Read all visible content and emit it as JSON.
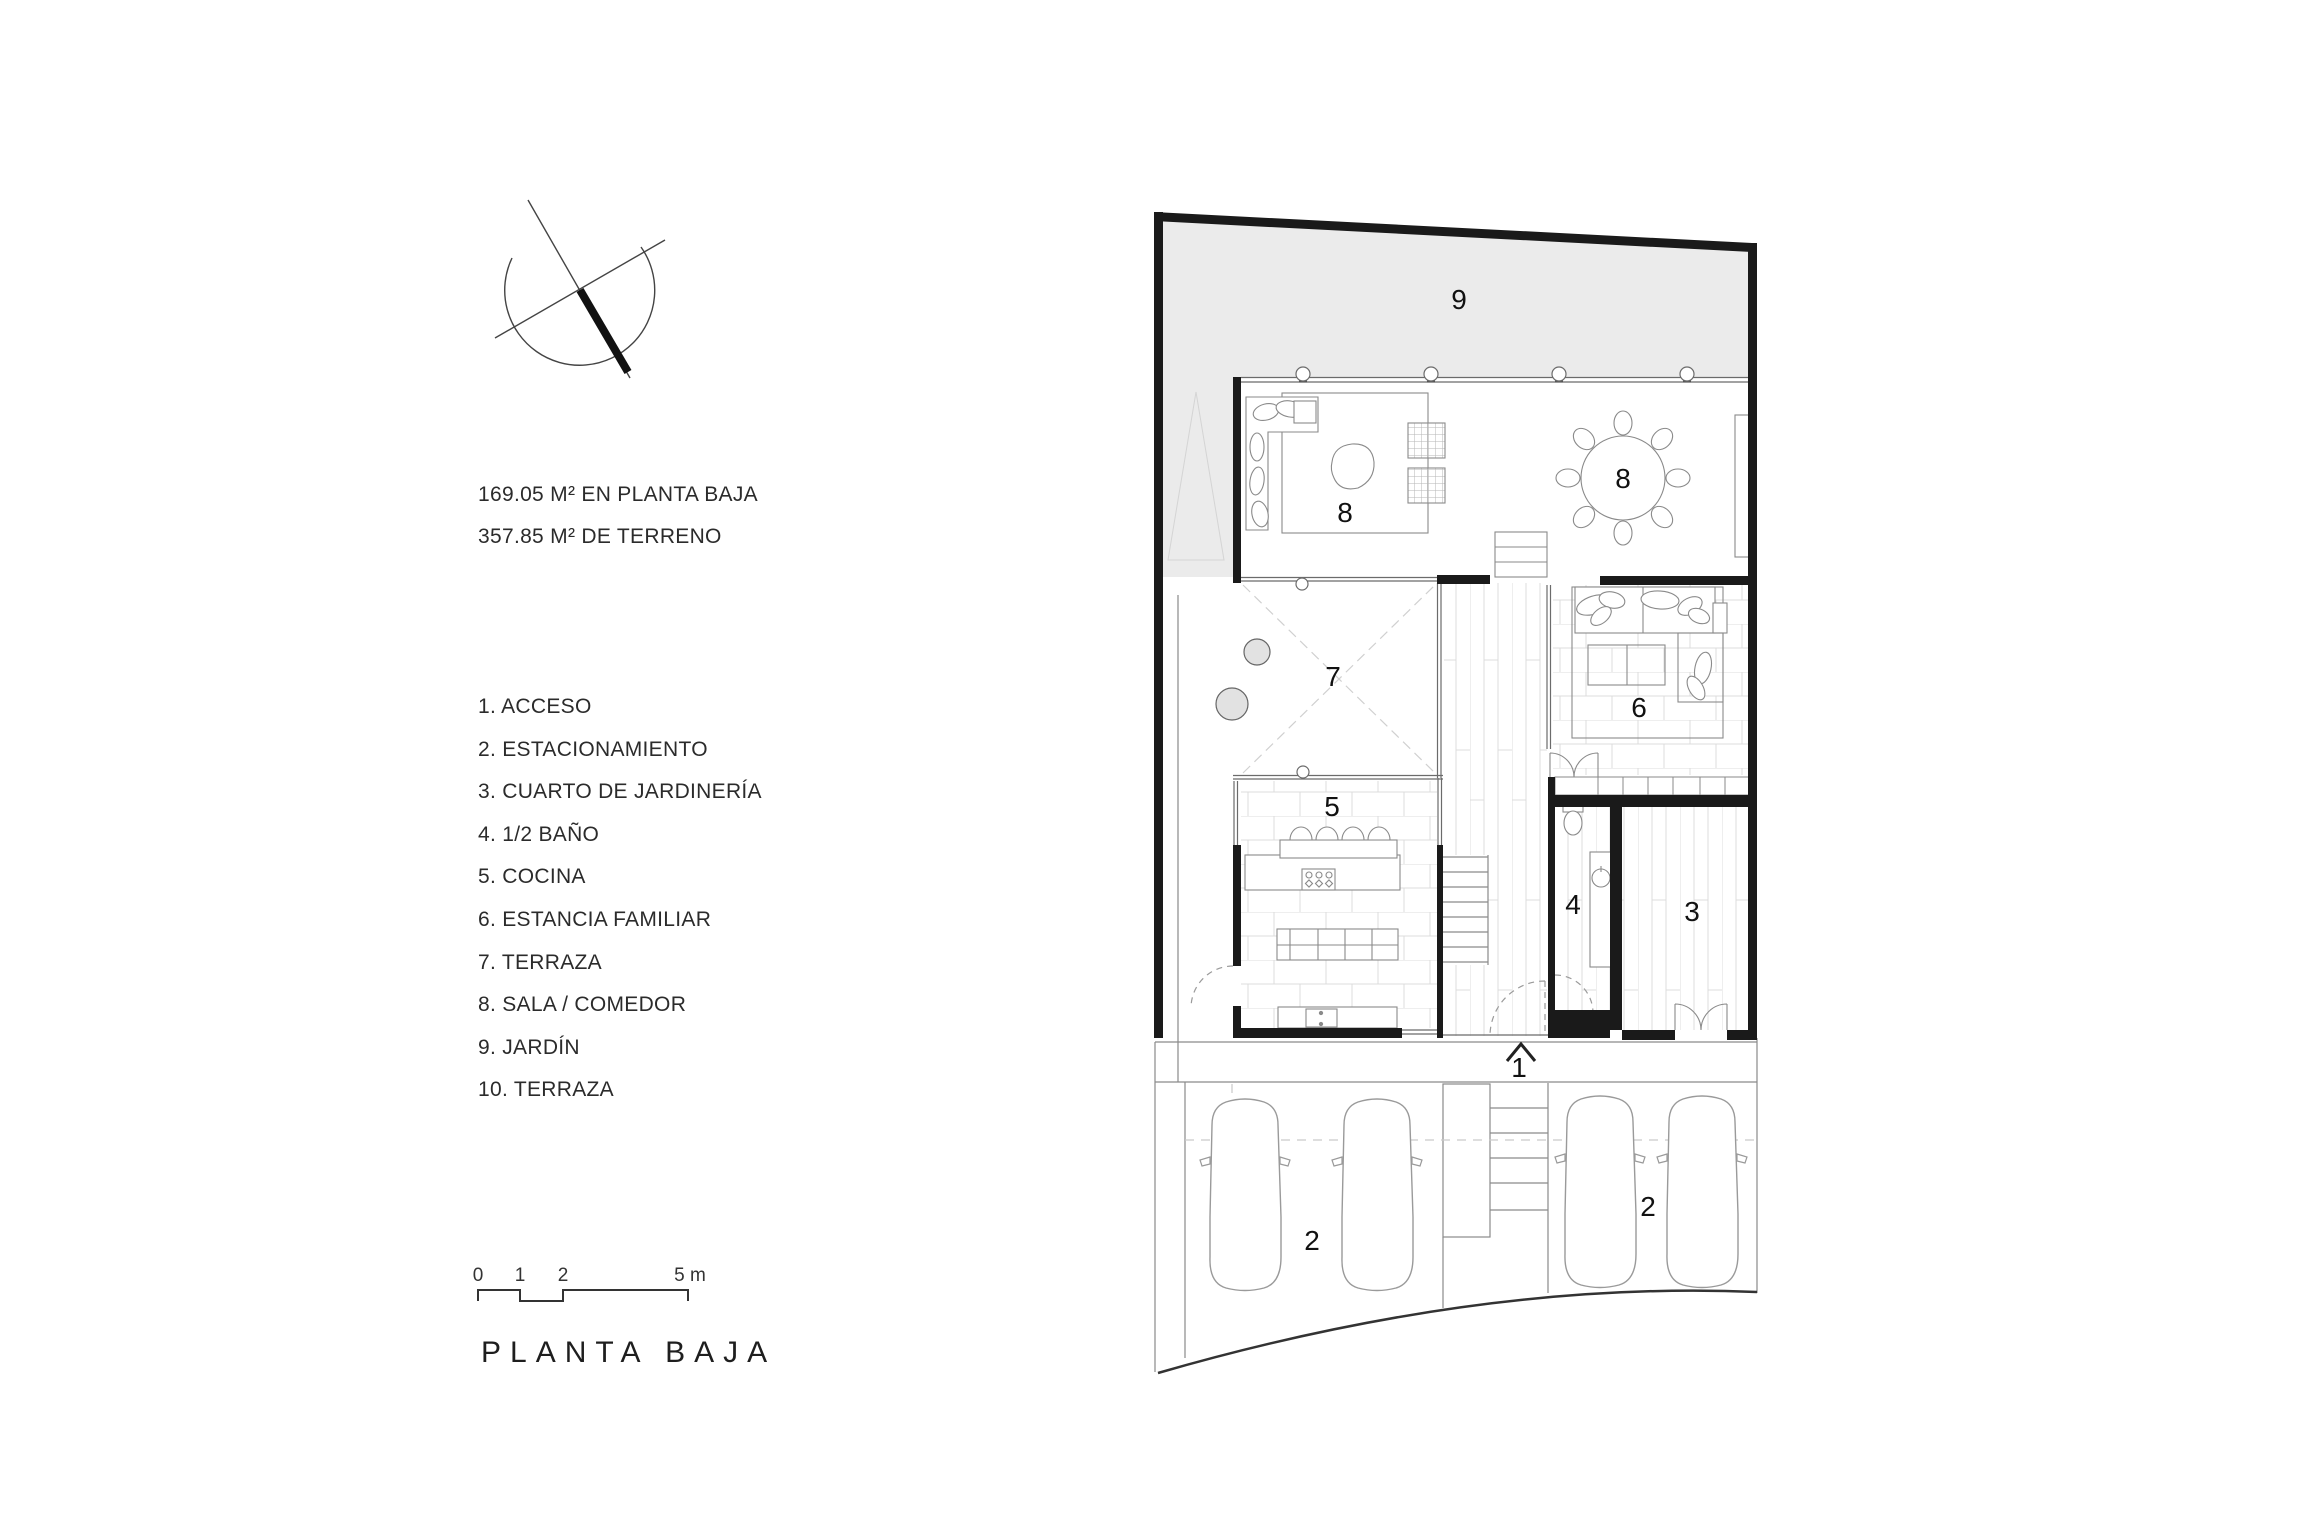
{
  "title": "PLANTA BAJA",
  "areas": [
    "169.05 M² EN PLANTA BAJA",
    "357.85 M² DE TERRENO"
  ],
  "legend": [
    "1. ACCESO",
    "2. ESTACIONAMIENTO",
    "3. CUARTO DE JARDINERÍA",
    "4. 1/2 BAÑO",
    "5. COCINA",
    "6. ESTANCIA FAMILIAR",
    "7. TERRAZA",
    "8. SALA / COMEDOR",
    "9. JARDÍN",
    "10. TERRAZA"
  ],
  "scale": {
    "t0": "0",
    "t1": "1",
    "t2": "2",
    "t5": "5 m"
  },
  "rooms": {
    "jardin": "9",
    "sala": "8",
    "comedor": "8",
    "terraza": "7",
    "estancia": "6",
    "cocina": "5",
    "banio": "4",
    "jardineria": "3",
    "acceso": "1",
    "estacionamiento_a": "2",
    "estacionamiento_b": "2"
  },
  "colors": {
    "wall": "#1a1a1a",
    "garden": "#ebebeb",
    "thin_line": "#6b6b6b",
    "paper": "#ffffff"
  }
}
